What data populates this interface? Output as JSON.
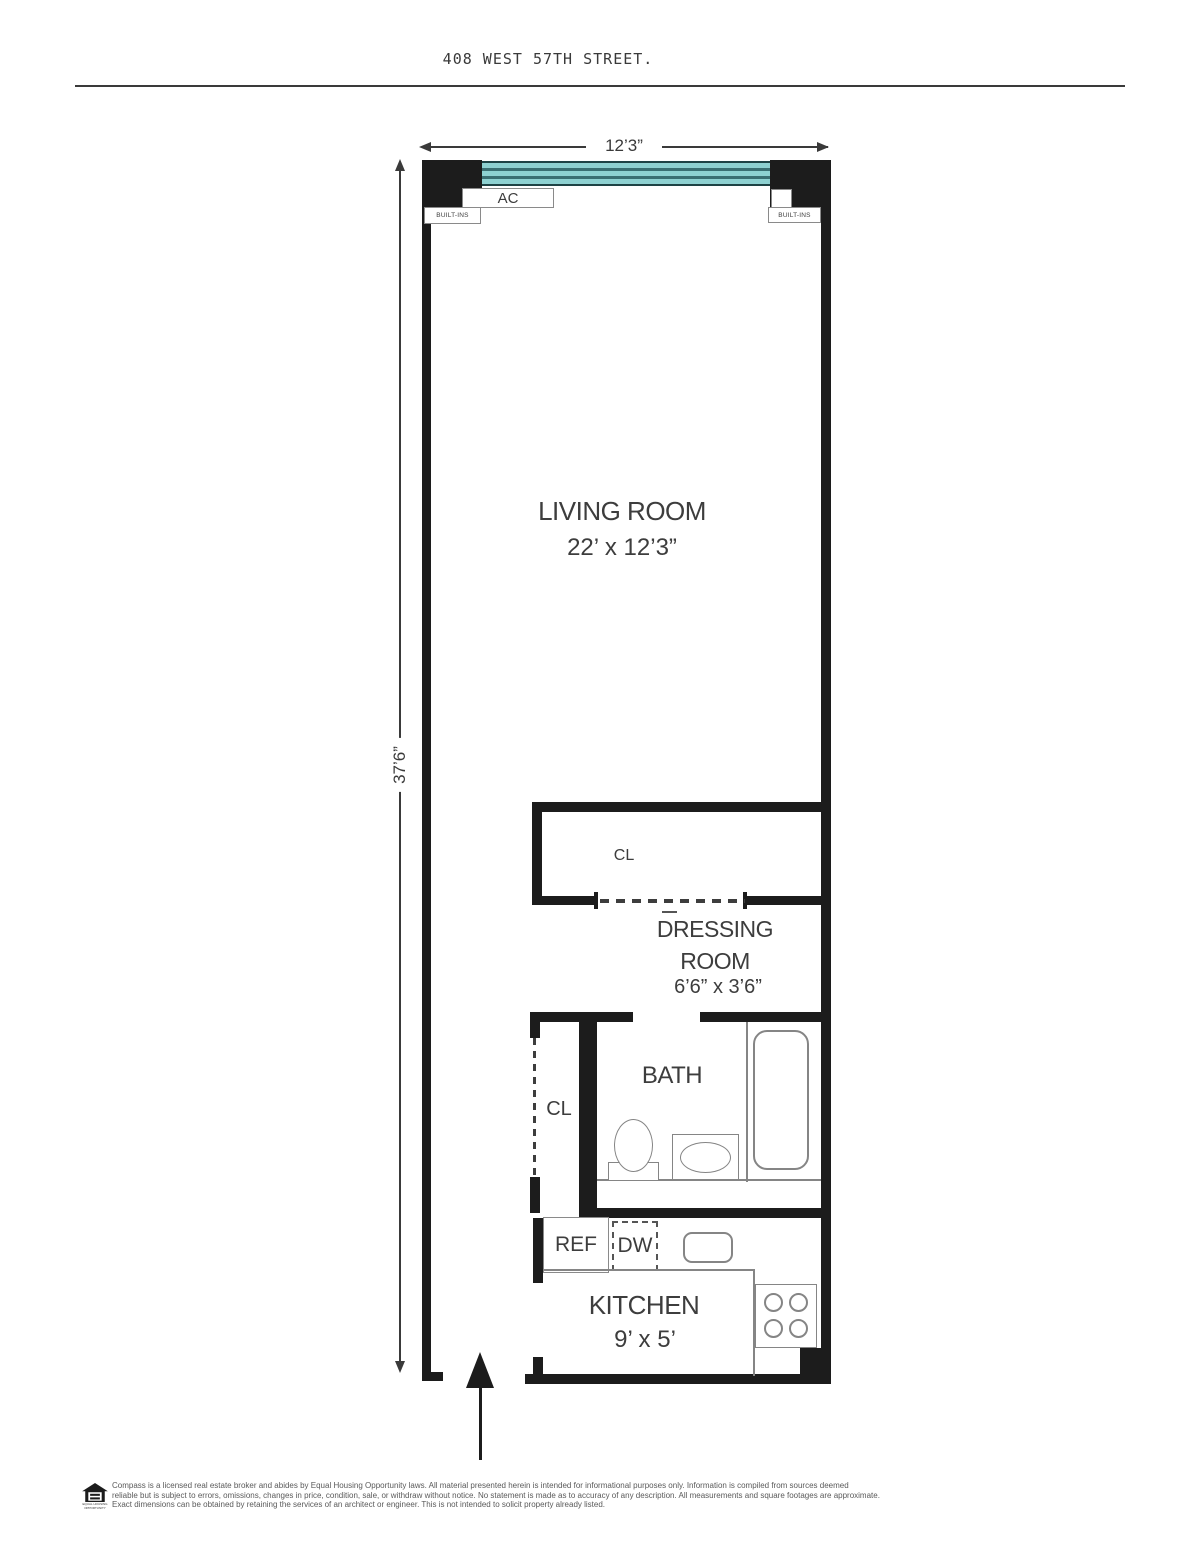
{
  "header": {
    "title": "408 WEST 57TH STREET."
  },
  "dimensions": {
    "top_width": "12’3”",
    "left_height": "37’6”"
  },
  "rooms": {
    "living": {
      "name": "LIVING ROOM",
      "size": "22’ x 12’3”"
    },
    "dressing": {
      "line1": "DRESSING",
      "line2": "ROOM",
      "size": "6’6” x 3’6”"
    },
    "bath": {
      "name": "BATH"
    },
    "kitchen": {
      "name": "KITCHEN",
      "size": "9’ x 5’"
    }
  },
  "labels": {
    "ac": "AC",
    "built_ins": "BUILT-INS",
    "closet": "CL",
    "ref": "REF",
    "dw": "DW"
  },
  "colors": {
    "wall": "#1c1c1c",
    "window_teal": "#8ed1d1",
    "window_stripe": "#3a6f72"
  },
  "footer": {
    "logo_caption": "EQUAL HOUSING OPPORTUNITY",
    "line1": "Compass is a licensed real estate broker and abides by Equal Housing Opportunity laws. All material presented herein is intended for informational purposes only. Information is compiled from sources deemed",
    "line2": "reliable but is subject to errors, omissions, changes in price, condition, sale, or withdraw without notice. No statement is made as to accuracy of any description. All measurements and square footages are approximate.",
    "line3": "Exact dimensions can be obtained by retaining the services of an architect or engineer. This is not intended to solicit property already listed."
  }
}
